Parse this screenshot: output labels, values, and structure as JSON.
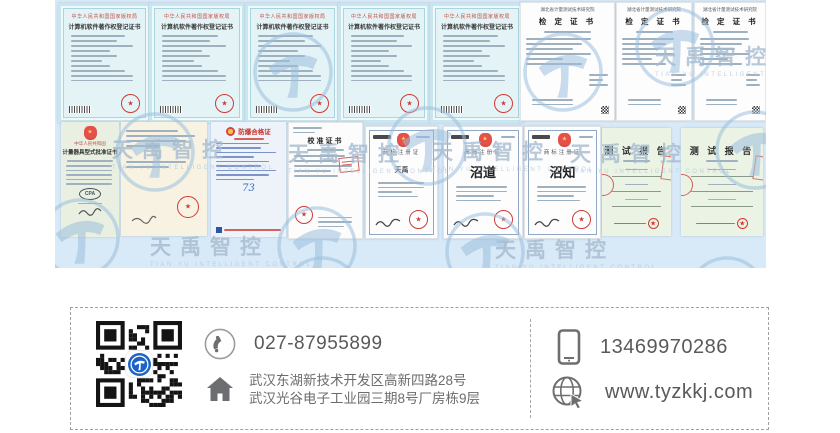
{
  "panel": {
    "bg": "#d8e9f7"
  },
  "watermark": {
    "text": "天禹智控",
    "caption": "TIAN YU INTELLIGENT CONTROL"
  },
  "certificates": [
    {
      "type": "soft",
      "x": 3,
      "y": 3,
      "w": 87,
      "h": 114,
      "header": "中华人民共和国国家版权局",
      "title": "计算机软件著作权登记证书"
    },
    {
      "type": "soft",
      "x": 94,
      "y": 3,
      "w": 90,
      "h": 114,
      "header": "中华人民共和国国家版权局",
      "title": "计算机软件著作权登记证书"
    },
    {
      "type": "soft",
      "x": 190,
      "y": 3,
      "w": 89,
      "h": 114,
      "header": "中华人民共和国国家版权局",
      "title": "计算机软件著作权登记证书"
    },
    {
      "type": "soft",
      "x": 283,
      "y": 3,
      "w": 86,
      "h": 114,
      "header": "中华人民共和国国家版权局",
      "title": "计算机软件著作权登记证书"
    },
    {
      "type": "soft",
      "x": 375,
      "y": 3,
      "w": 88,
      "h": 114,
      "header": "中华人民共和国国家版权局",
      "title": "计算机软件著作权登记证书"
    },
    {
      "type": "jd",
      "x": 465,
      "y": 2,
      "w": 93,
      "h": 117,
      "header": "湖北省计量测试技术研究院",
      "title": "检 定 证 书"
    },
    {
      "type": "jd",
      "x": 561,
      "y": 2,
      "w": 74,
      "h": 117,
      "header": "湖北省计量测试技术研究院",
      "title": "检 定 证 书"
    },
    {
      "type": "jd",
      "x": 639,
      "y": 2,
      "w": 70,
      "h": 117,
      "header": "湖北省计量测试技术研究院",
      "title": "检 定 证 书"
    },
    {
      "type": "ap",
      "x": 6,
      "y": 122,
      "w": 58,
      "h": 115,
      "country": "中华人民共和国",
      "title": "计量器具型式批准证书",
      "mark": "CPA"
    },
    {
      "type": "letter",
      "x": 66,
      "y": 122,
      "w": 86,
      "h": 114
    },
    {
      "type": "fb",
      "x": 156,
      "y": 122,
      "w": 75,
      "h": 115,
      "title": "防爆合格证",
      "number": "73"
    },
    {
      "type": "jz",
      "x": 233,
      "y": 122,
      "w": 73,
      "h": 115,
      "title": "校准证书"
    },
    {
      "type": "tm",
      "x": 310,
      "y": 126,
      "w": 71,
      "h": 111,
      "title": "商标注册证",
      "mark": "天禹",
      "size": "small"
    },
    {
      "type": "tm",
      "x": 388,
      "y": 126,
      "w": 78,
      "h": 111,
      "title": "商标注册证",
      "mark": "沼道",
      "size": "large"
    },
    {
      "type": "tm",
      "x": 469,
      "y": 126,
      "w": 75,
      "h": 111,
      "title": "商标注册证",
      "mark": "沼知",
      "size": "large"
    },
    {
      "type": "tr",
      "x": 547,
      "y": 128,
      "w": 69,
      "h": 108,
      "title": "测 试 报 告"
    },
    {
      "type": "tr",
      "x": 626,
      "y": 128,
      "w": 82,
      "h": 108,
      "title": "测 试 报 告"
    }
  ],
  "contact": {
    "phone": "027-87955899",
    "mobile": "13469970286",
    "website": "www.tyzkkj.com",
    "address_line1": "武汉东湖新技术开发区高新四路28号",
    "address_line2": "武汉光谷电子工业园三期8号厂房栋9层"
  }
}
